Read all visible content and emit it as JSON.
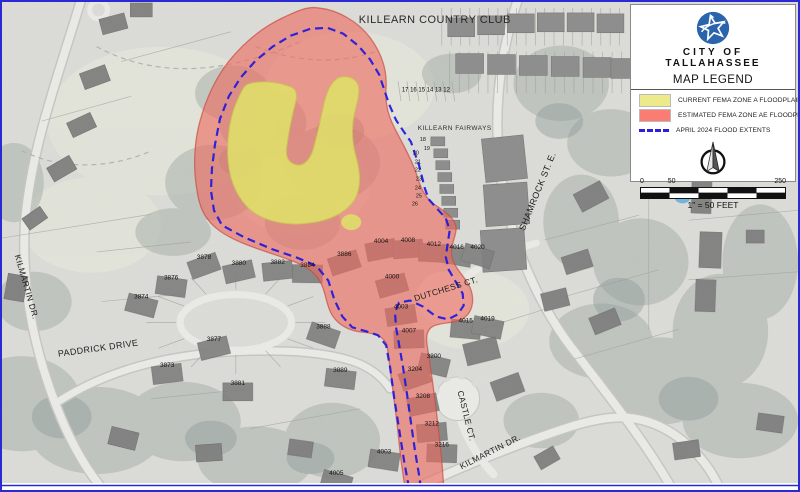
{
  "legend": {
    "org_line1": "CITY OF",
    "org_line2": "TALLAHASSEE",
    "title": "MAP LEGEND",
    "items": [
      {
        "label": "CURRENT FEMA ZONE A FLOODPLAIN",
        "color": "#EDEA8C",
        "swatch": "fill"
      },
      {
        "label": "ESTIMATED FEMA ZONE AE FLOODPLAIN",
        "color": "#FA7C72",
        "swatch": "fill"
      },
      {
        "label": "APRIL 2024 FLOOD EXTENTS",
        "color": "#2A1FE0",
        "swatch": "dashed-line"
      }
    ],
    "scale": {
      "tick0": "0",
      "tick1": "50",
      "tick2": "250",
      "caption": "1\" = 50 FEET"
    }
  },
  "map": {
    "area_labels": [
      {
        "text": "KILLEARN COUNTRY CLUB",
        "x": 435,
        "y": 21,
        "rot": 0,
        "size": 11
      },
      {
        "text": "KILLEARN FAIRWAYS",
        "x": 455,
        "y": 129,
        "rot": 0,
        "size": 6.5
      }
    ],
    "street_labels": [
      {
        "text": "SHAMROCK ST. E.",
        "x": 541,
        "y": 192,
        "rot": -68,
        "size": 9
      },
      {
        "text": "KILMARTIN DR.",
        "x": 22,
        "y": 288,
        "rot": 74,
        "size": 8.5
      },
      {
        "text": "PADDRICK DRIVE",
        "x": 97,
        "y": 352,
        "rot": -8,
        "size": 9
      },
      {
        "text": "DUTCHESS CT.",
        "x": 447,
        "y": 292,
        "rot": -17,
        "size": 8.5
      },
      {
        "text": "CASTLE CT.",
        "x": 464,
        "y": 418,
        "rot": 76,
        "size": 8.5
      },
      {
        "text": "KILMARTIN DR.",
        "x": 492,
        "y": 456,
        "rot": -27,
        "size": 8.5
      }
    ],
    "lot_row_label": {
      "text": "17 16 15 14 13 12",
      "x": 426,
      "y": 90,
      "size": 6
    },
    "unit_numbers": [
      {
        "text": "18",
        "x": 423,
        "y": 140
      },
      {
        "text": "19",
        "x": 427,
        "y": 149
      },
      {
        "text": "20",
        "x": 416,
        "y": 154
      },
      {
        "text": "21",
        "x": 418,
        "y": 163
      },
      {
        "text": "22",
        "x": 418,
        "y": 171
      },
      {
        "text": "23",
        "x": 419,
        "y": 180
      },
      {
        "text": "24",
        "x": 418,
        "y": 189
      },
      {
        "text": "25",
        "x": 419,
        "y": 197
      },
      {
        "text": "26",
        "x": 415,
        "y": 205
      }
    ],
    "house_numbers": [
      {
        "text": "3878",
        "x": 203,
        "y": 259
      },
      {
        "text": "3880",
        "x": 238,
        "y": 265
      },
      {
        "text": "3882",
        "x": 277,
        "y": 264
      },
      {
        "text": "3884",
        "x": 307,
        "y": 267
      },
      {
        "text": "3876",
        "x": 170,
        "y": 280
      },
      {
        "text": "3874",
        "x": 140,
        "y": 299
      },
      {
        "text": "3886",
        "x": 344,
        "y": 256
      },
      {
        "text": "4004",
        "x": 381,
        "y": 243
      },
      {
        "text": "4008",
        "x": 408,
        "y": 242
      },
      {
        "text": "4012",
        "x": 434,
        "y": 246
      },
      {
        "text": "4016",
        "x": 457,
        "y": 249
      },
      {
        "text": "4020",
        "x": 478,
        "y": 249
      },
      {
        "text": "4000",
        "x": 392,
        "y": 279
      },
      {
        "text": "4003",
        "x": 401,
        "y": 309
      },
      {
        "text": "4007",
        "x": 409,
        "y": 333
      },
      {
        "text": "4015",
        "x": 466,
        "y": 323
      },
      {
        "text": "4019",
        "x": 488,
        "y": 321
      },
      {
        "text": "3888",
        "x": 323,
        "y": 329
      },
      {
        "text": "3877",
        "x": 213,
        "y": 342
      },
      {
        "text": "3873",
        "x": 166,
        "y": 368
      },
      {
        "text": "3881",
        "x": 237,
        "y": 386
      },
      {
        "text": "3889",
        "x": 340,
        "y": 373
      },
      {
        "text": "3200",
        "x": 434,
        "y": 359
      },
      {
        "text": "3204",
        "x": 415,
        "y": 372
      },
      {
        "text": "3208",
        "x": 423,
        "y": 399
      },
      {
        "text": "3212",
        "x": 432,
        "y": 427
      },
      {
        "text": "3216",
        "x": 442,
        "y": 448
      },
      {
        "text": "4003",
        "x": 384,
        "y": 455
      },
      {
        "text": "4005",
        "x": 336,
        "y": 477
      }
    ]
  },
  "colors": {
    "zone_a_yellow": "#EDEA8C",
    "zone_ae_red": "#FA7C72",
    "flood_extent_blue": "#2A1FE0",
    "map_border_blue": "#2A2AD4",
    "logo_blue": "#2A64AD"
  }
}
